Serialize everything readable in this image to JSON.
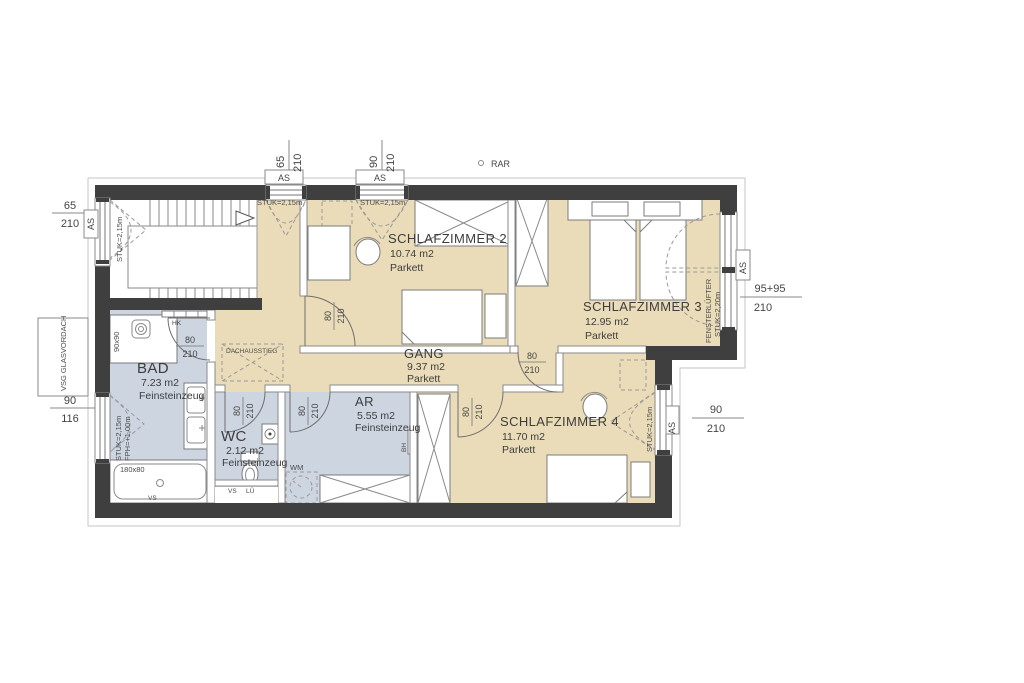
{
  "drawing": {
    "kind": "floor plan, upper storey"
  },
  "rooms": {
    "sz2": {
      "name": "SCHLAFZIMMER 2",
      "area": "10.74 m2",
      "floor": "Parkett"
    },
    "sz3": {
      "name": "SCHLAFZIMMER 3",
      "area": "12.95 m2",
      "floor": "Parkett"
    },
    "sz4": {
      "name": "SCHLAFZIMMER 4",
      "area": "11.70 m2",
      "floor": "Parkett"
    },
    "gang": {
      "name": "GANG",
      "area": "9.37 m2",
      "floor": "Parkett"
    },
    "bad": {
      "name": "BAD",
      "area": "7.23 m2",
      "floor": "Feinsteinzeug"
    },
    "wc": {
      "name": "WC",
      "area": "2.12 m2",
      "floor": "Feinsteinzeug"
    },
    "ar": {
      "name": "AR",
      "area": "5.55 m2",
      "floor": "Feinsteinzeug"
    }
  },
  "doors": {
    "w": "80",
    "h": "210"
  },
  "windows": {
    "left_stair": {
      "w": "65",
      "h": "210",
      "as": "AS",
      "stuk": "STUK=2,15m"
    },
    "dormer1": {
      "w": "65",
      "h": "210",
      "as": "AS",
      "stuk": "STUK=2,15m"
    },
    "dormer2": {
      "w": "90",
      "h": "210",
      "as": "AS",
      "stuk": "STUK=2,15m"
    },
    "sz3_right": {
      "w": "95+95",
      "h": "210",
      "as": "AS",
      "type": "FENSTERLÜFTER",
      "stuk": "STUK=2,20m"
    },
    "sz4_right": {
      "w": "90",
      "h": "210",
      "as": "AS",
      "stuk": "STUK=2,15m"
    },
    "bad_left": {
      "w": "90",
      "h": "116",
      "stuk": "STUK=2,15m",
      "fph": "FPH=+1,00m"
    }
  },
  "labels": {
    "rar": "RAR",
    "vsg": "VSG GLASVORDACH",
    "dachausstieg": "DACHAUSSTIEG",
    "hk": "HK",
    "wm": "WM",
    "bh": "BH",
    "vs": "VS",
    "lue": "LÜ",
    "shower": "90x90",
    "tub": "180x80"
  },
  "colors": {
    "wall": "#3F3F3F",
    "parkett_room": "#EADCB8",
    "feinsteinzeug_room": "#CDD5E1",
    "line": "#8A8A8A"
  }
}
